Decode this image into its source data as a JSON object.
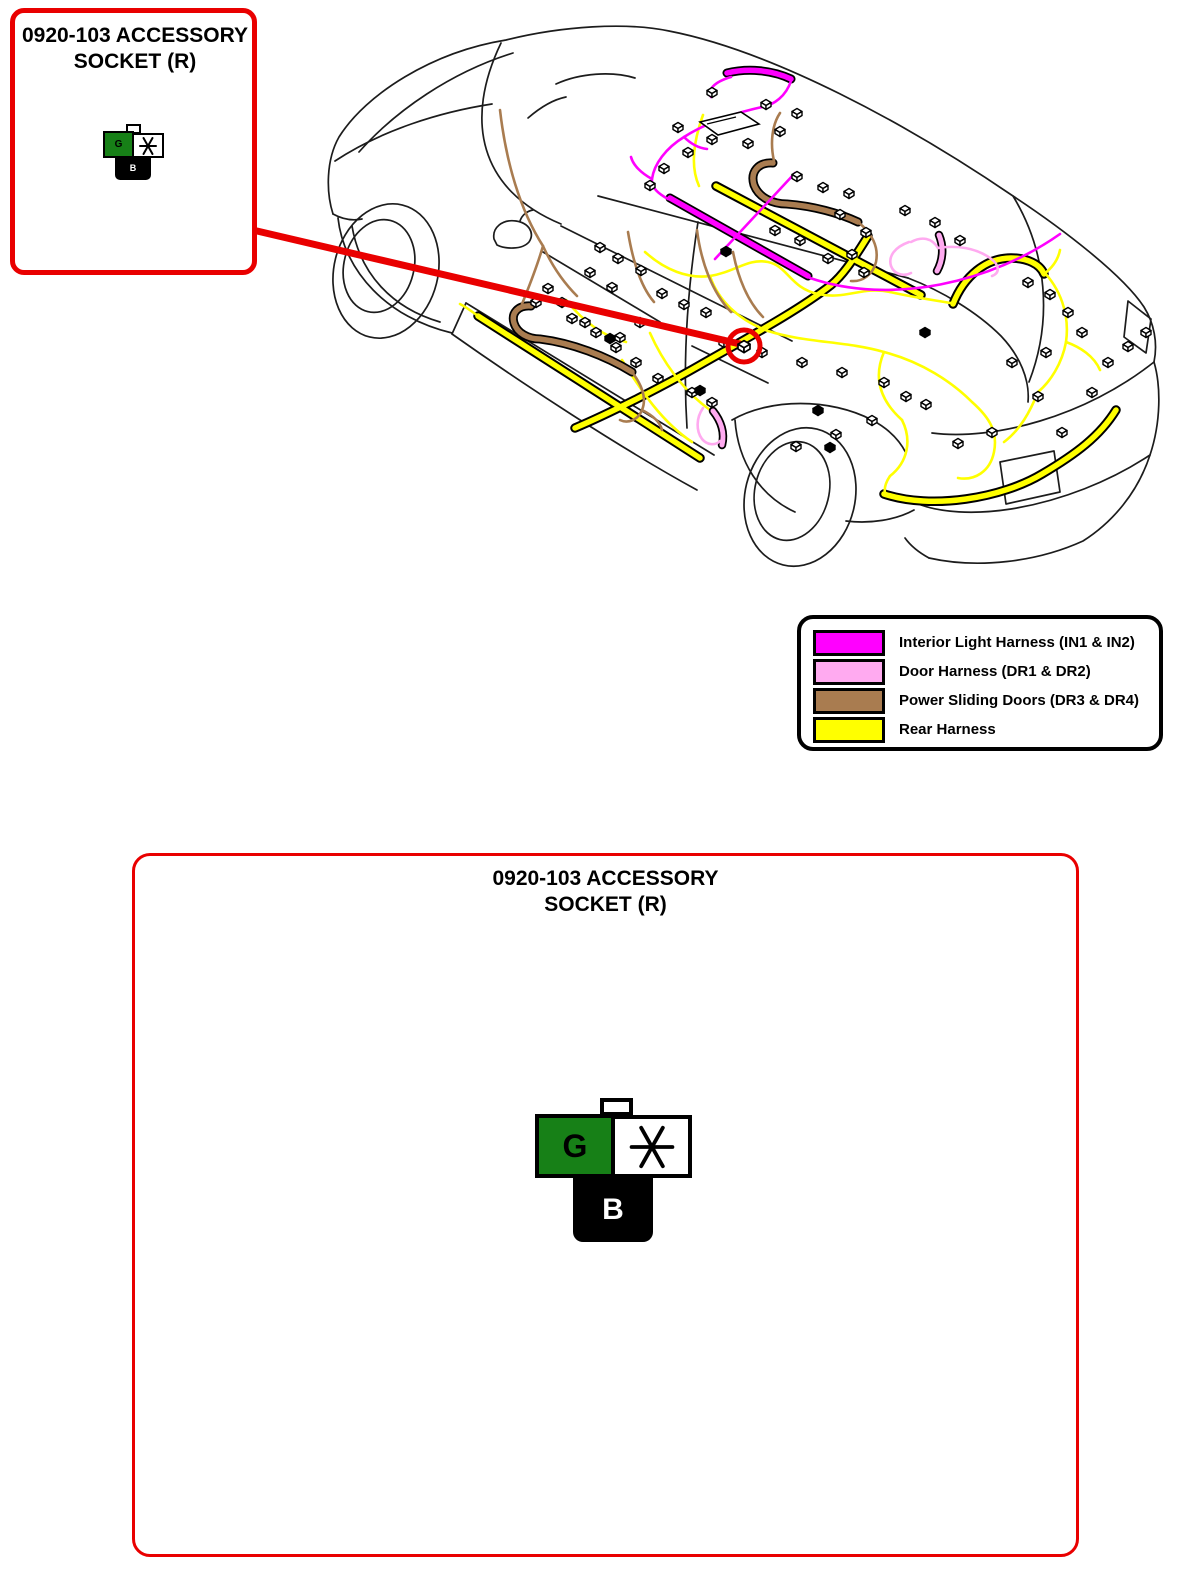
{
  "callouts": {
    "small": {
      "title": "0920-103 ACCESSORY SOCKET (R)"
    },
    "large": {
      "title": "0920-103 ACCESSORY SOCKET (R)"
    }
  },
  "connector": {
    "green_label": "G",
    "black_label": "B",
    "green_color": "#178017",
    "black_color": "#000000",
    "white_color": "#FFFFFF"
  },
  "legend": {
    "items": [
      {
        "name": "interior-light-harness",
        "label": "Interior Light Harness (IN1 & IN2)",
        "color": "#FF00FF"
      },
      {
        "name": "door-harness",
        "label": "Door Harness (DR1 & DR2)",
        "color": "#FFAAF0"
      },
      {
        "name": "power-sliding-doors",
        "label": "Power Sliding Doors (DR3 & DR4)",
        "color": "#A97C50"
      },
      {
        "name": "rear-harness",
        "label": "Rear Harness",
        "color": "#FFFF00"
      }
    ]
  },
  "diagram": {
    "marker_color": "#E90000",
    "body_line_color": "#1C1C1C",
    "harness_colors": {
      "interior_light": "#FF00FF",
      "door": "#FFAAF0",
      "power_sliding_doors": "#A97C50",
      "rear": "#FFFF00"
    }
  }
}
